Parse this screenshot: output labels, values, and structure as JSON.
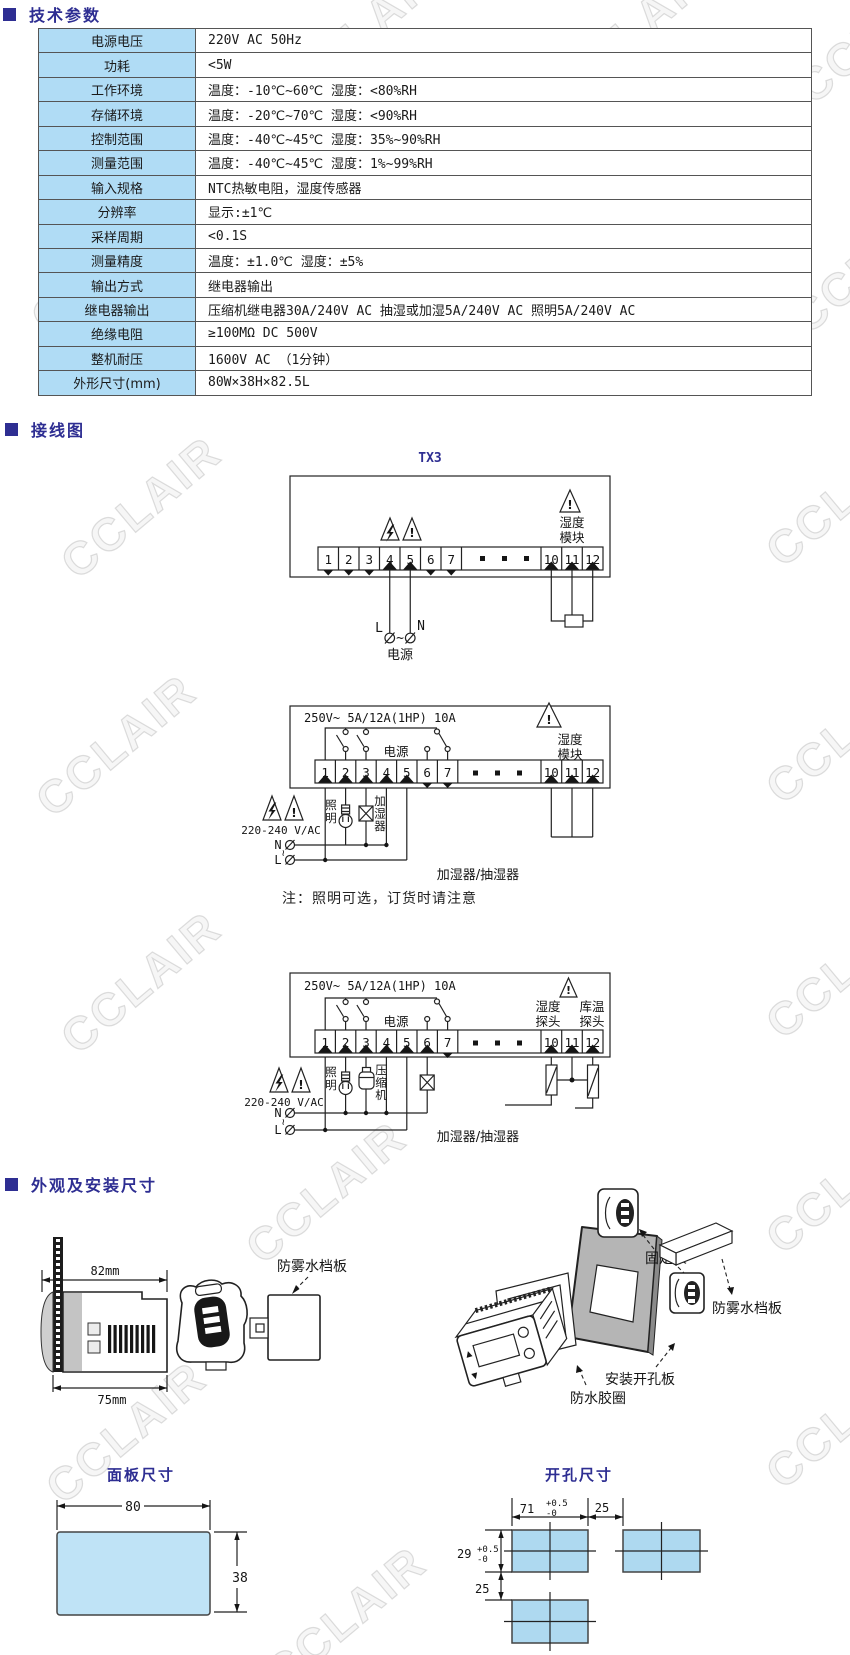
{
  "watermark": {
    "text": "CCLAIR"
  },
  "sections": {
    "tech": "技术参数",
    "wiring": "接线图",
    "install": "外观及安装尺寸"
  },
  "tech_table": {
    "rows": [
      {
        "label": "电源电压",
        "value": "220V AC   50Hz"
      },
      {
        "label": "功耗",
        "value": "<5W"
      },
      {
        "label": "工作环境",
        "value": "温度：-10℃~60℃  湿度：<80%RH"
      },
      {
        "label": "存储环境",
        "value": "温度：-20℃~70℃  湿度：<90%RH"
      },
      {
        "label": "控制范围",
        "value": "温度：-40℃~45℃  湿度：35%~90%RH"
      },
      {
        "label": "测量范围",
        "value": "温度：-40℃~45℃  湿度：1%~99%RH"
      },
      {
        "label": "输入规格",
        "value": "NTC热敏电阻，湿度传感器"
      },
      {
        "label": "分辨率",
        "value": "显示:±1℃"
      },
      {
        "label": "采样周期",
        "value": "<0.1S"
      },
      {
        "label": "测量精度",
        "value": "温度：±1.0℃  湿度：±5%"
      },
      {
        "label": "输出方式",
        "value": "继电器输出"
      },
      {
        "label": "继电器输出",
        "value": "压缩机继电器30A/240V AC  抽湿或加湿5A/240V AC  照明5A/240V AC"
      },
      {
        "label": "绝缘电阻",
        "value": "≥100MΩ  DC 500V"
      },
      {
        "label": "整机耐压",
        "value": "1600V AC （1分钟）"
      },
      {
        "label": "外形尺寸(mm)",
        "value": "80W×38H×82.5L"
      }
    ]
  },
  "wiring": {
    "tilde": "~",
    "terminals_left": [
      "1",
      "2",
      "3",
      "4",
      "5",
      "6",
      "7"
    ],
    "terminals_right": [
      "10",
      "11",
      "12"
    ],
    "d1": {
      "title": "TX3",
      "module": [
        "湿度",
        "模块"
      ],
      "power": "电源",
      "l": "L",
      "n": "N",
      "warn": "!"
    },
    "d2": {
      "rating": "250V~ 5A/12A(1HP) 10A",
      "power": "电源",
      "module": [
        "湿度",
        "模块"
      ],
      "mains": "220-240 V/AC",
      "n": "N",
      "l": "L",
      "lighting": [
        "照",
        "明"
      ],
      "humidifier": [
        "加",
        "湿",
        "器"
      ],
      "load": "加湿器/抽湿器",
      "warn": "!"
    },
    "note": "注：照明可选，订货时请注意",
    "d3": {
      "rating": "250V~ 5A/12A(1HP) 10A",
      "power": "电源",
      "probe_h": [
        "湿度",
        "探头"
      ],
      "probe_t": [
        "库温",
        "探头"
      ],
      "mains": "220-240 V/AC",
      "n": "N",
      "l": "L",
      "lighting": [
        "照",
        "明"
      ],
      "compressor": [
        "压",
        "缩",
        "机"
      ],
      "load": "加湿器/抽湿器",
      "warn": "!"
    }
  },
  "install": {
    "dim_top": "82mm",
    "dim_bottom": "75mm",
    "baffle": "防雾水档板",
    "bracket": "固定架",
    "baffle2": "防雾水档板",
    "panel": "安装开孔板",
    "gasket": "防水胶圈",
    "panel_size": {
      "title": "面板尺寸",
      "width": "80",
      "height": "38"
    },
    "cutout": {
      "title": "开孔尺寸",
      "width": "71",
      "tol_p": "+0.5",
      "tol_m": "-0",
      "gap_h": "25",
      "height": "29",
      "tol_p2": "+0.5",
      "tol_m2": "-0",
      "gap_v": "25"
    }
  }
}
